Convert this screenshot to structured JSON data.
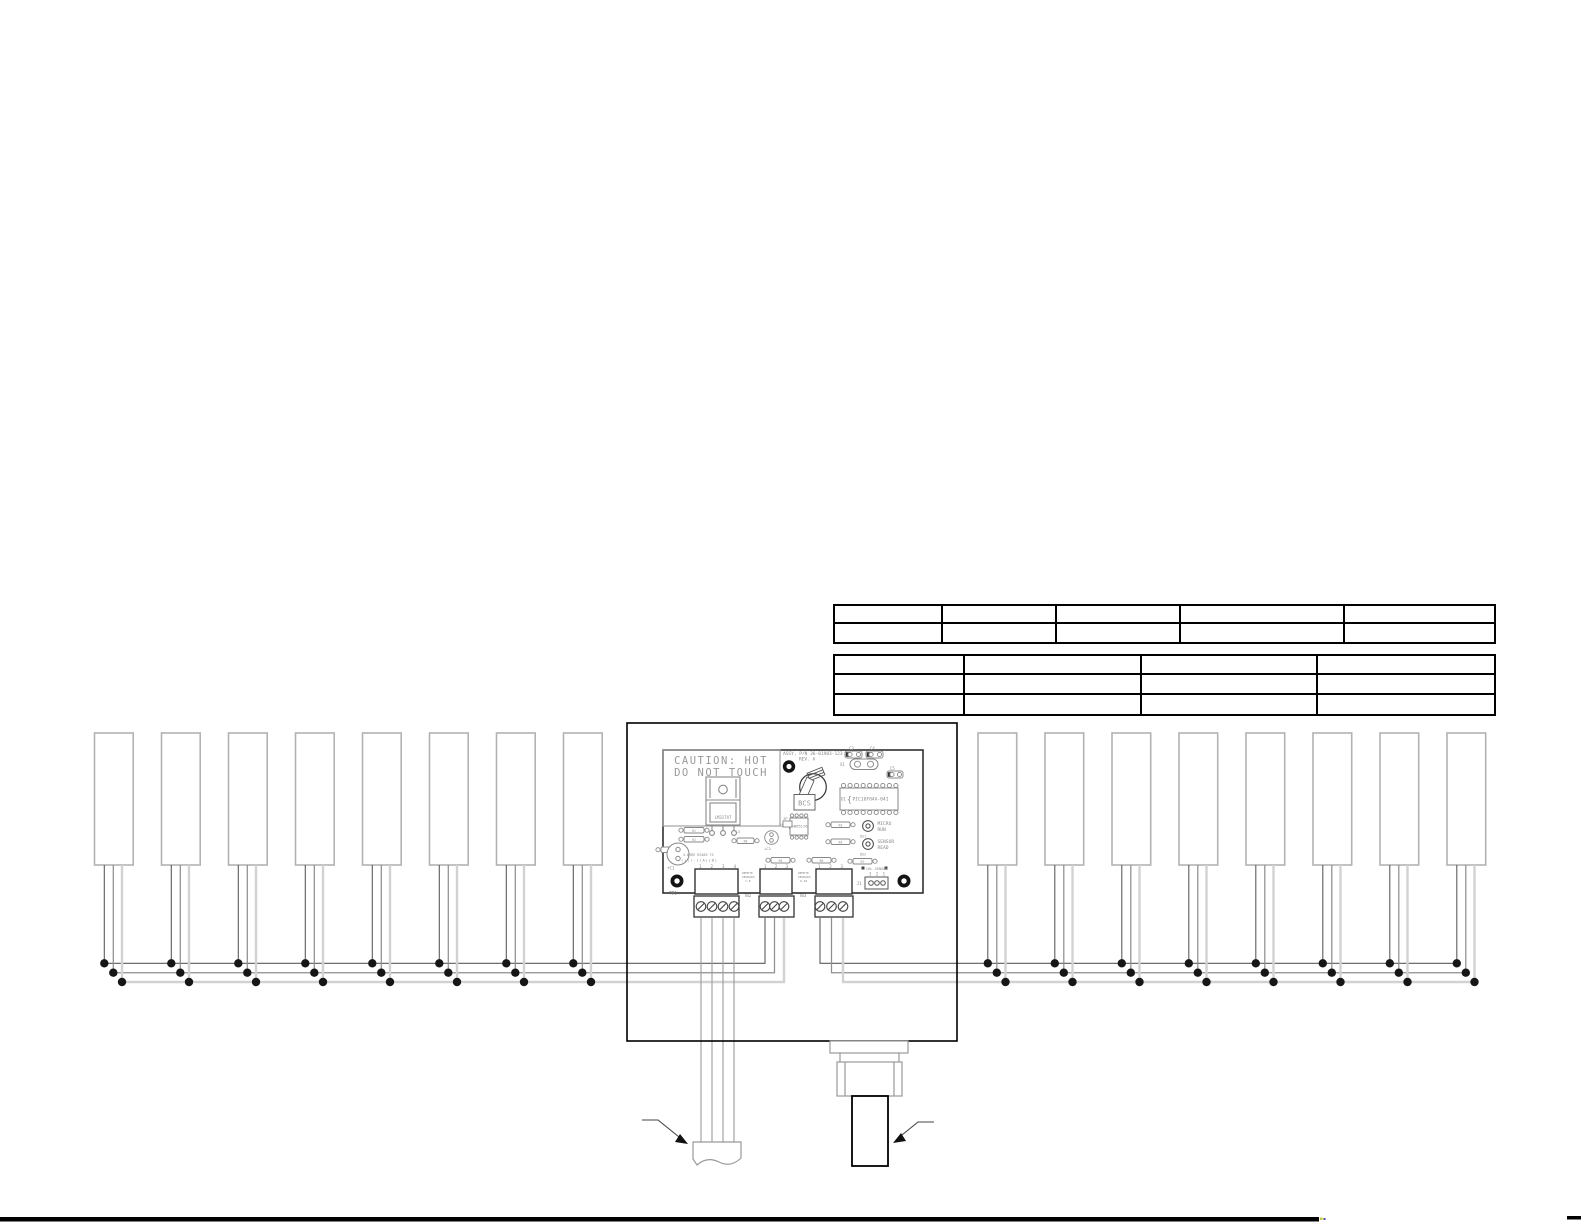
{
  "tables": {
    "upper": {
      "rows": [
        [
          "",
          "",
          "",
          "",
          ""
        ],
        [
          "",
          "",
          "",
          "",
          ""
        ]
      ]
    },
    "lower": {
      "rows": [
        [
          "",
          "",
          "",
          ""
        ],
        [
          "",
          "",
          "",
          ""
        ],
        [
          "",
          "",
          "",
          ""
        ]
      ]
    }
  },
  "sensors": {
    "left_count": 8,
    "right_count": 8
  },
  "pcb": {
    "caution_line1": "CAUTION: HOT",
    "caution_line2": "DO NOT TOUCH",
    "regulator": "LM317AT",
    "assy": "ASSY, P/N 36-01903-123",
    "rev": "REV. A",
    "switch_label": "BCS",
    "osc": "X1",
    "c1": "+C1",
    "c2": "+C2",
    "c3": "C3",
    "c4": "C4",
    "c5": "C5",
    "u1_ref": "U1",
    "u1_part": "PIC16F84A-04I",
    "u2_ref": "U2",
    "u2_part": "SN65176",
    "jp": "JP",
    "l3": "L3",
    "resistor_labels": [
      "R1",
      "R2",
      "R3",
      "R4",
      "R5",
      "R6",
      "R7",
      "R8",
      ""
    ],
    "led1_line1": "MICRO",
    "led1_line2": "RUN",
    "ds1": "DS1",
    "led2_line1": "SENSOR",
    "led2_line2": "READ",
    "ds2": "DS2",
    "cal_label": "CAL SENSOR",
    "j1_pins": "3 2 1",
    "j1": "J1",
    "tb1_note1": "4-WIRE RS485 TX",
    "tb1_note2": "(+)(-)(A)(B)",
    "tb1_pins": "1 2 3 4",
    "tb1": "TB1",
    "tb2_note1": "REMOTE",
    "tb2_note2": "SENSORS",
    "tb2_note3": "1-8",
    "tb2_pins": "1 2 3",
    "tb2": "TB2",
    "tb3_note1": "REMOTE",
    "tb3_note2": "SENSORS",
    "tb3_note3": "9-16",
    "tb3_pins": "1 2 3",
    "tb3": "TB3"
  },
  "colors": {
    "wire_dark": "#5c5c5c",
    "wire_mid": "#8f8f8f",
    "wire_light": "#d2d2d2",
    "silk": "#888888",
    "line": "#000000"
  }
}
